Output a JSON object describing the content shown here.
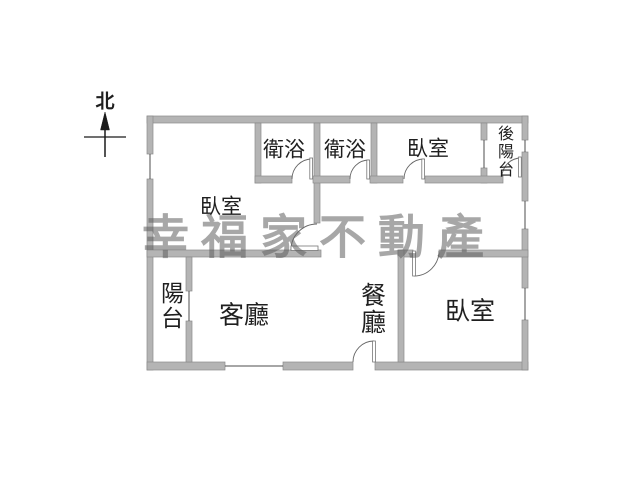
{
  "north": {
    "label": "北"
  },
  "watermark": {
    "text": "幸福家不動產",
    "color": "#9a9a9a"
  },
  "rooms": {
    "bathroom_1": "衛浴",
    "bathroom_2": "衛浴",
    "bedroom_top_right": "臥室",
    "back_balcony": "後陽台",
    "bedroom_left": "臥室",
    "balcony": "陽台",
    "living_room": "客廳",
    "dining_room": "餐廳",
    "bedroom_bottom_right": "臥室"
  },
  "colors": {
    "wall_fill": "#b4b4b4",
    "wall_stroke": "#8a8a8a",
    "line": "#4d4d4d",
    "text": "#1f1f1f"
  }
}
